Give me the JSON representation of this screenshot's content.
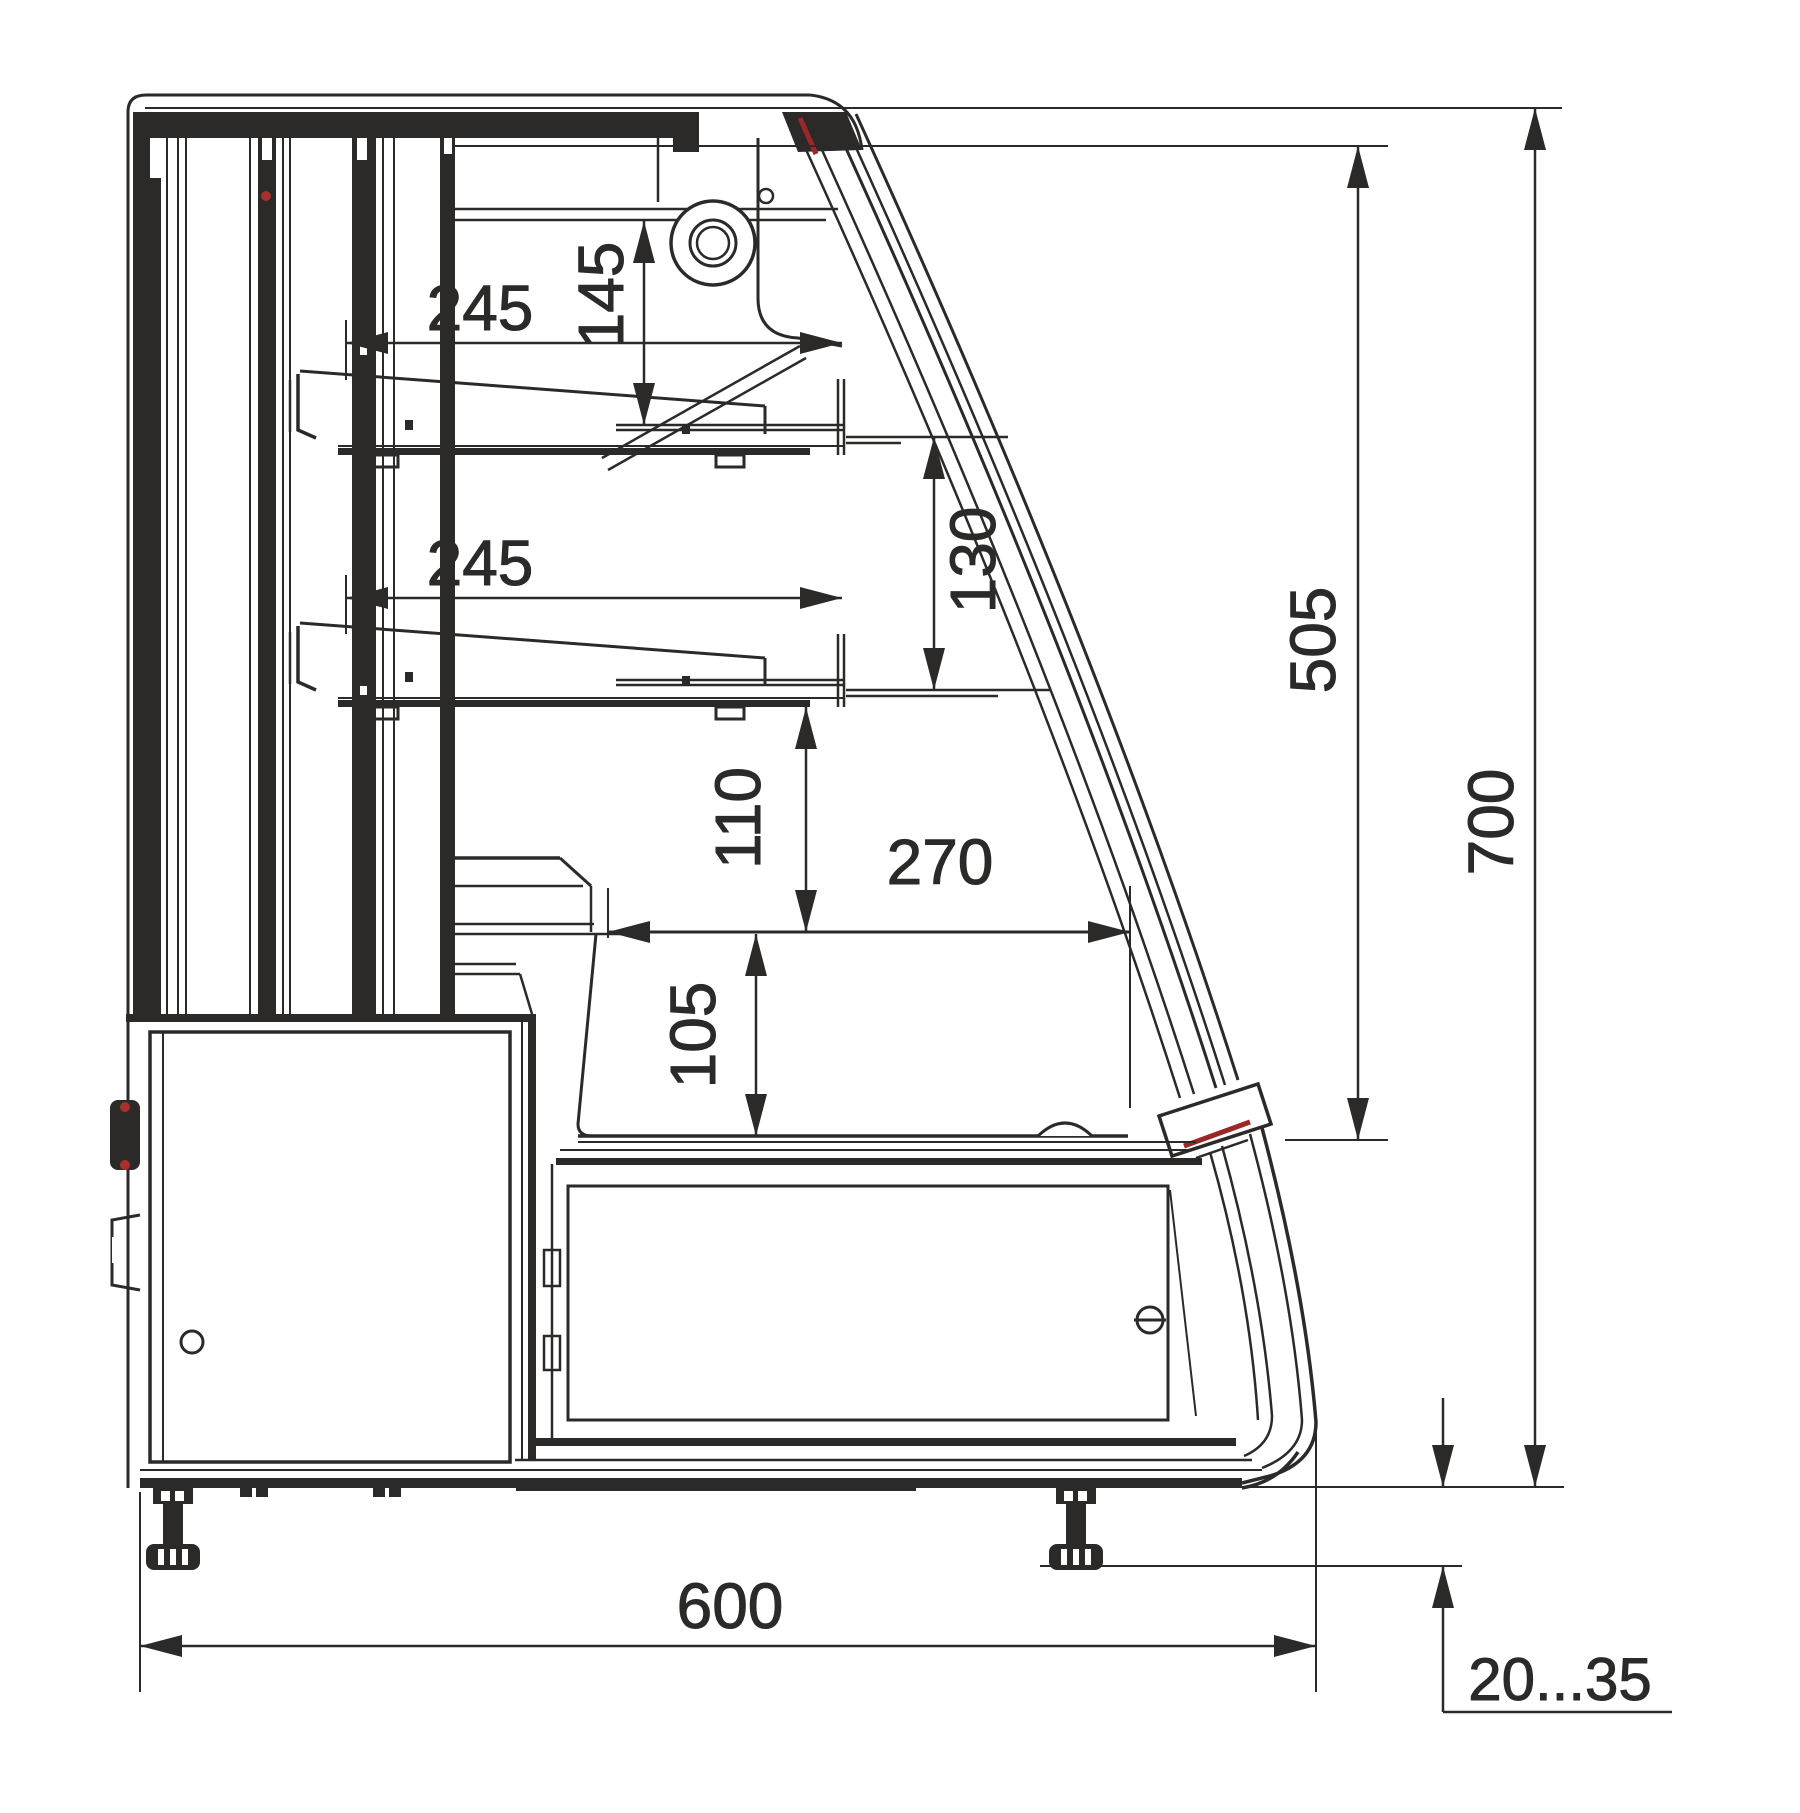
{
  "drawing": {
    "type": "technical-section-drawing",
    "subject": "display case side cross-section with dimensions",
    "units": "mm",
    "colors": {
      "line": "#2b2a29",
      "accent_red": "#a8302c",
      "background": "#ffffff"
    },
    "dims": {
      "shelf1_width": "245",
      "canopy_to_shelf1": "145",
      "shelf2_width": "245",
      "shelf1_to_shelf2": "130",
      "shelf2_to_well": "110",
      "well_width": "270",
      "well_depth": "105",
      "glass_height": "505",
      "overall_height": "700",
      "overall_depth": "600",
      "foot_adjustment": "20...35"
    }
  }
}
